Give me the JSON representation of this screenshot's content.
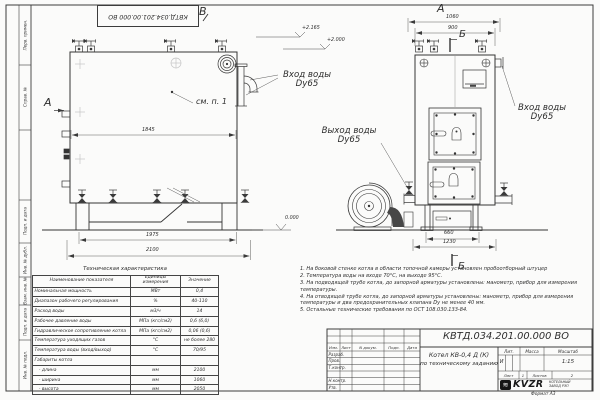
{
  "doc": {
    "number_top": "КВТД.034.201.00.000  ВО",
    "number": "КВТД.034.201.00.000  ВО",
    "format": "Формат  А3"
  },
  "frame": {
    "side_labels": [
      "Перв. примен.",
      "Справ. №",
      "Подп. и дата",
      "Инв. № дубл.",
      "Взам. инв. №",
      "Подп. и дата",
      "Инв. № подл."
    ]
  },
  "annotations": {
    "view_a_side": "А",
    "view_b": "В",
    "view_a_front": "А",
    "section_b_top": "Б",
    "section_b_bottom": "Б",
    "see_note": "см. п. 1",
    "elev_top1": "+2.165",
    "elev_top2": "+2.000",
    "elev_zero": "0.000",
    "inlet_side_1": "Вход воды",
    "inlet_side_2": "Dy65",
    "inlet_front_1": "Вход воды",
    "inlet_front_2": "Dy65",
    "outlet_1": "Выход воды",
    "outlet_2": "Dy65"
  },
  "dimensions": {
    "side_width": "1845",
    "side_1975": "1975",
    "side_2100": "2100",
    "front_1060": "1060",
    "front_900": "900",
    "front_660": "660",
    "front_1230": "1230"
  },
  "spec_table": {
    "title": "Техническая характеристика",
    "headers": [
      "Наименование показателя",
      "Единицы измерения",
      "Значение"
    ],
    "rows": [
      [
        "Номинальная мощность",
        "МВт",
        "0,4"
      ],
      [
        "Диапазон рабочего регулирования",
        "%",
        "40-110"
      ],
      [
        "Расход воды",
        "м3/ч",
        "14"
      ],
      [
        "Рабочее давление воды",
        "МПа (кгс/см2)",
        "0,6 (6,0)"
      ],
      [
        "Гидравлическое сопротивление котла",
        "МПа (кгс/см2)",
        "0,06 (0,6)"
      ],
      [
        "Температура уходящих газов",
        "°С",
        "не более 280"
      ],
      [
        "Температура воды (вход/выход)",
        "°С",
        "70/95"
      ],
      [
        "Габариты котла",
        "",
        ""
      ],
      [
        "   - длина",
        "мм",
        "2100"
      ],
      [
        "   - ширина",
        "мм",
        "1060"
      ],
      [
        "   - высота",
        "мм",
        "2050"
      ]
    ]
  },
  "notes": [
    "1.  На боковой стенке котла в области топочной камеры установлен пробоотборный штуцер",
    "2.  Температура воды на входе 70°С, на выходе 95°С.",
    "3.  На подводящей трубе котла, до запорной арматуры установлены: манометр, прибор для измерения температуры.",
    "4.  На отводящей трубе котла, до запорной арматуры установлены: манометр, прибор для измерения температуры и два предохранительных клапана  Dу не менее 40 мм.",
    "5.  Остальные технические требования по ОСТ  108.030.133-84."
  ],
  "title_block": {
    "header_cols": [
      "Изм.",
      "Лист",
      "N докум.",
      "Подп.",
      "Дата"
    ],
    "rows": [
      "Разраб.",
      "Пров.",
      "Т.контр.",
      "Н.контр.",
      "Утв."
    ],
    "title_line1": "Котел  КВ-0,4  Д  (К)",
    "title_line2": "по техническому заданию",
    "lit_header": "Лит.",
    "mass_header": "Масса",
    "scale_header": "Масштаб",
    "lit_value": "И",
    "scale_value": "1:15",
    "sheet_label": "Лист",
    "sheet_value": "1",
    "sheets_label": "Листов",
    "sheets_value": "2",
    "logo_icon": "≋",
    "logo_text": "KVZR",
    "logo_sub1": "КОТЕЛЬНЫЙ",
    "logo_sub2": "ЗАВОД РЭП"
  }
}
